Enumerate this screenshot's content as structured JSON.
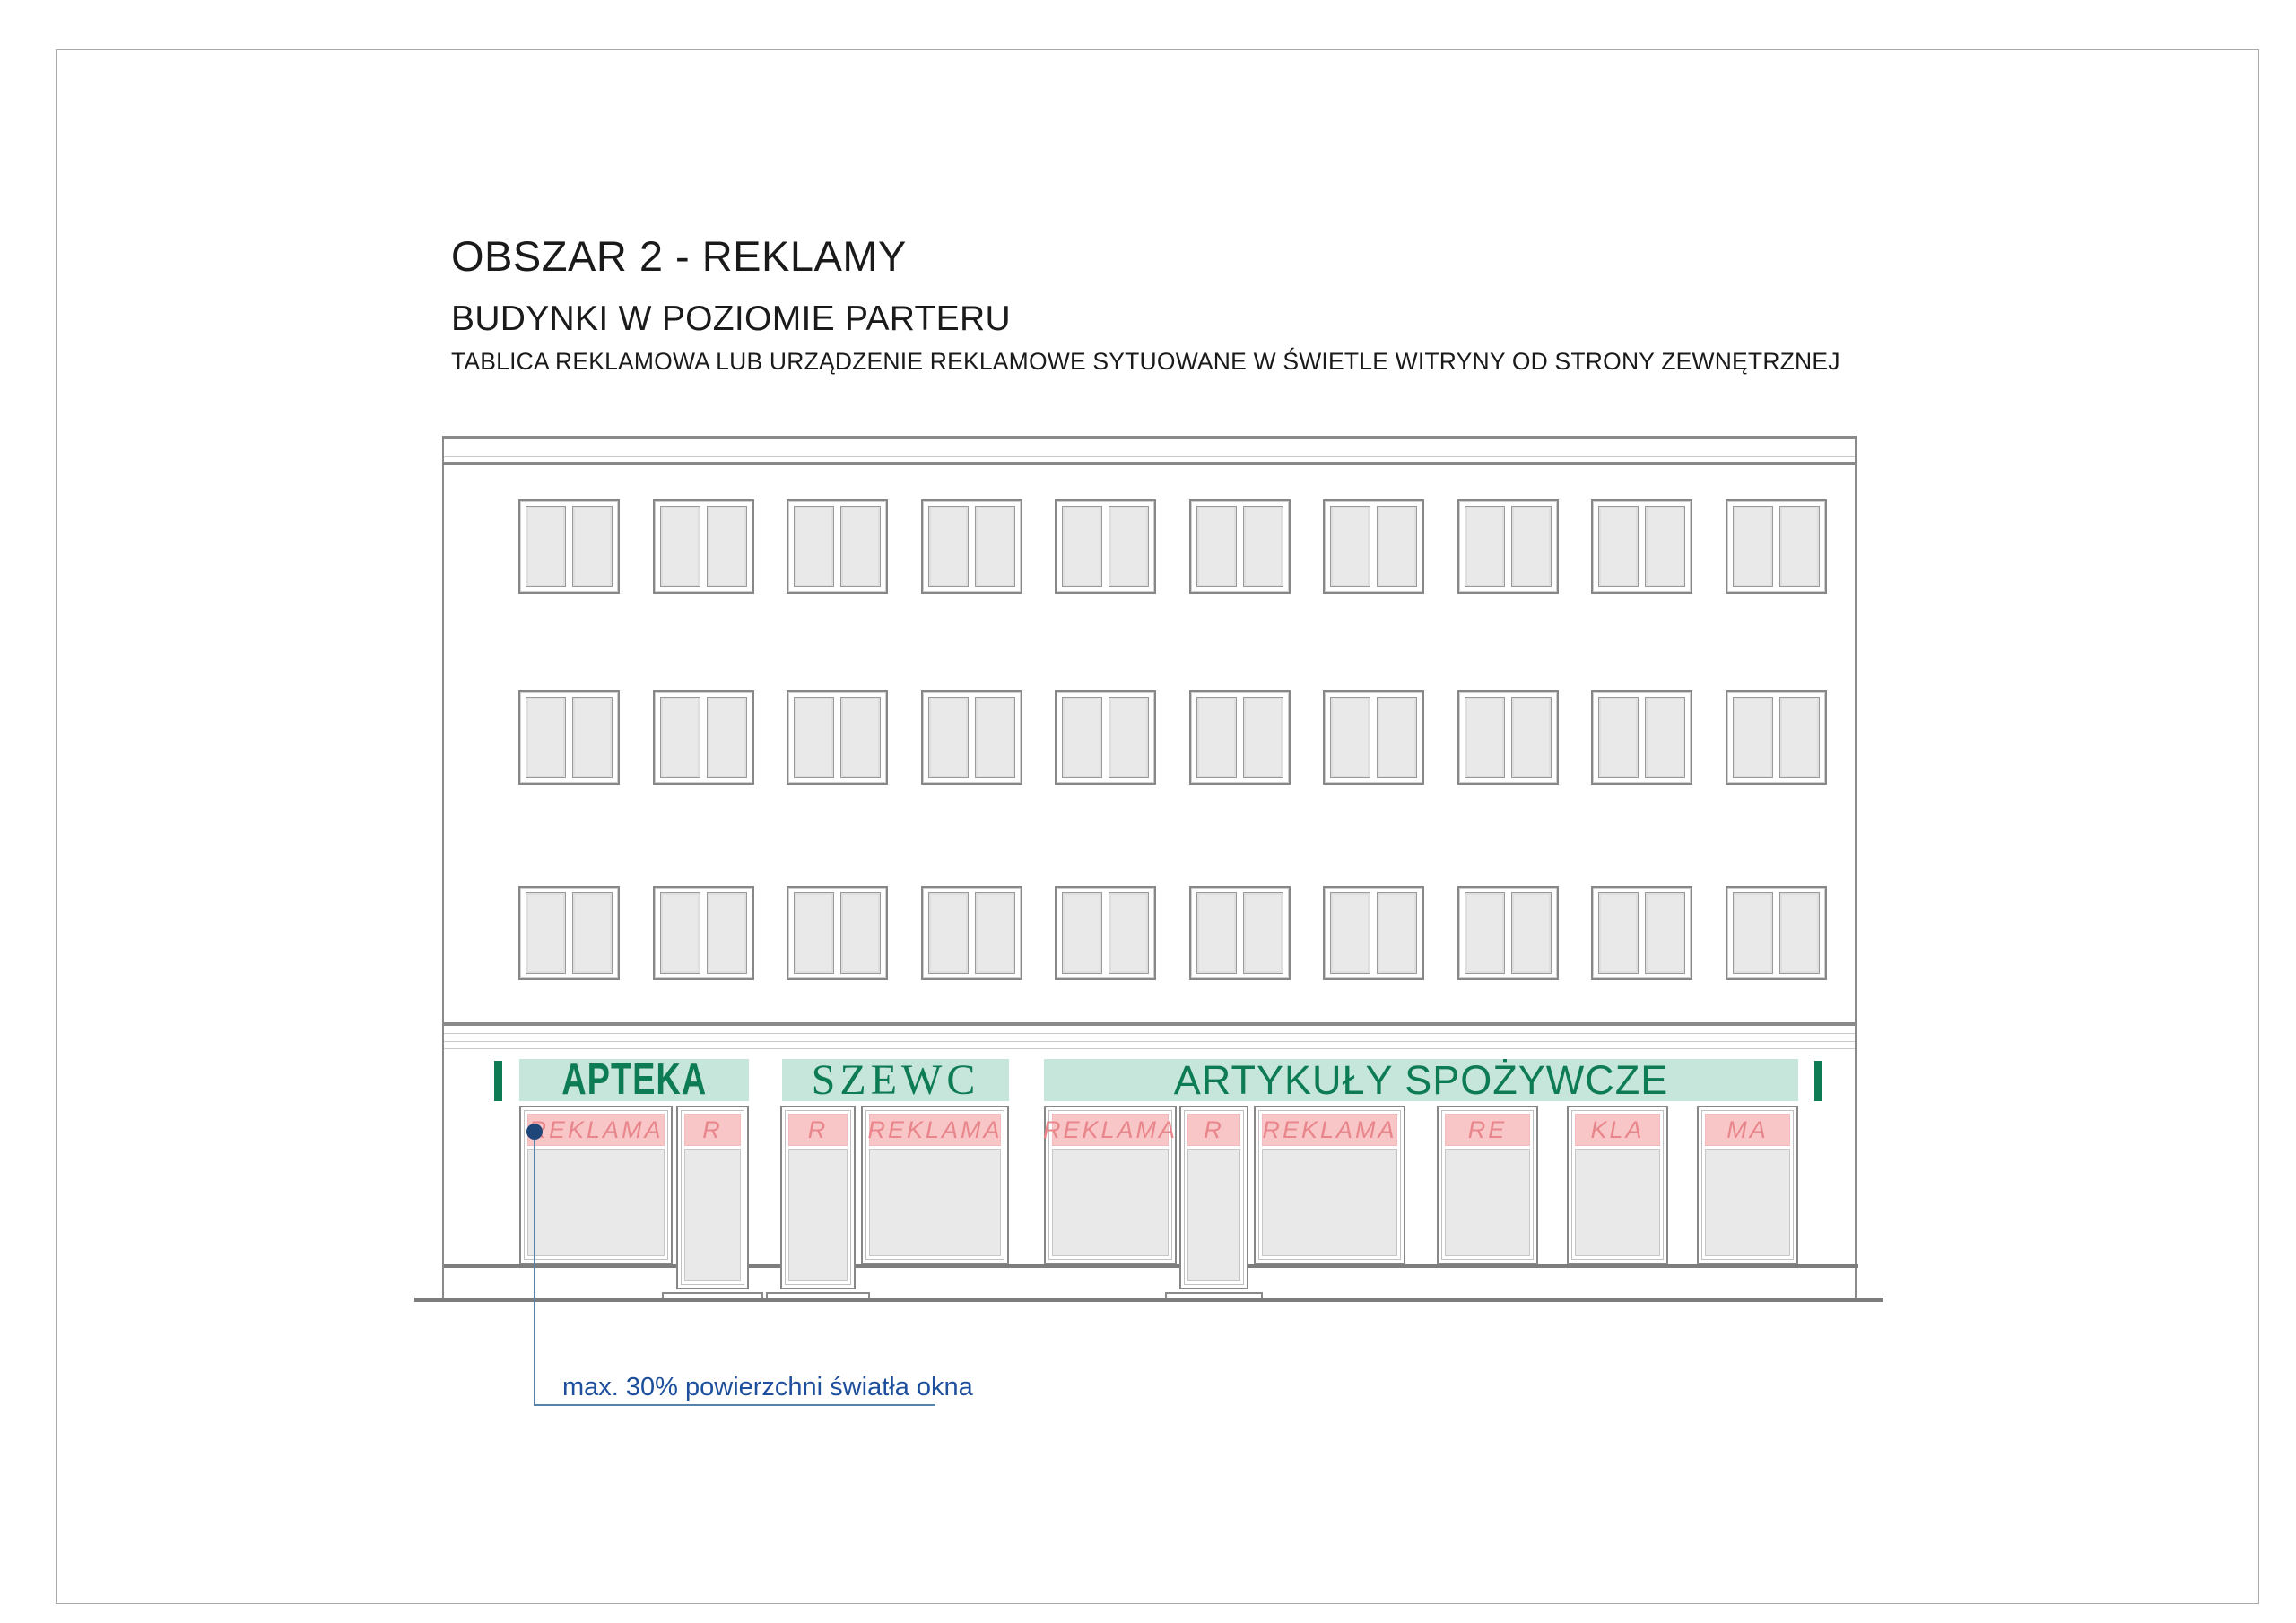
{
  "page": {
    "title": "OBSZAR 2 - REKLAMY",
    "subtitle": "BUDYNKI W POZIOMIE PARTERU",
    "description": "TABLICA REKLAMOWA LUB URZĄDZENIE REKLAMOWE SYTUOWANE W ŚWIETLE WITRYNY OD STRONY ZEWNĘTRZNEJ"
  },
  "colors": {
    "sign_band_bg": "#c6e6db",
    "sign_text_green": "#0d7b53",
    "ad_strip_bg": "#f9c6c8",
    "ad_strip_text": "#e8868c",
    "annotation_blue": "#1d4f9c",
    "leader_blue": "#5583ab",
    "dot_navy": "#1e4678",
    "line_gray": "#8a8a8a",
    "glass_gray": "#e9e9e9"
  },
  "building": {
    "upper_window_rows": 3,
    "windows_per_row": 10,
    "signs": [
      {
        "name": "APTEKA"
      },
      {
        "name": "SZEWC"
      },
      {
        "name": "ARTYKUŁY SPOŻYWCZE"
      }
    ],
    "ad_strip_labels": [
      "REKLAMA",
      "R",
      "R",
      "REKLAMA",
      "REKLAMA",
      "R",
      "REKLAMA",
      "RE",
      "KLA",
      "MA"
    ]
  },
  "annotation": {
    "label": "max. 30% powierzchni światła okna"
  }
}
